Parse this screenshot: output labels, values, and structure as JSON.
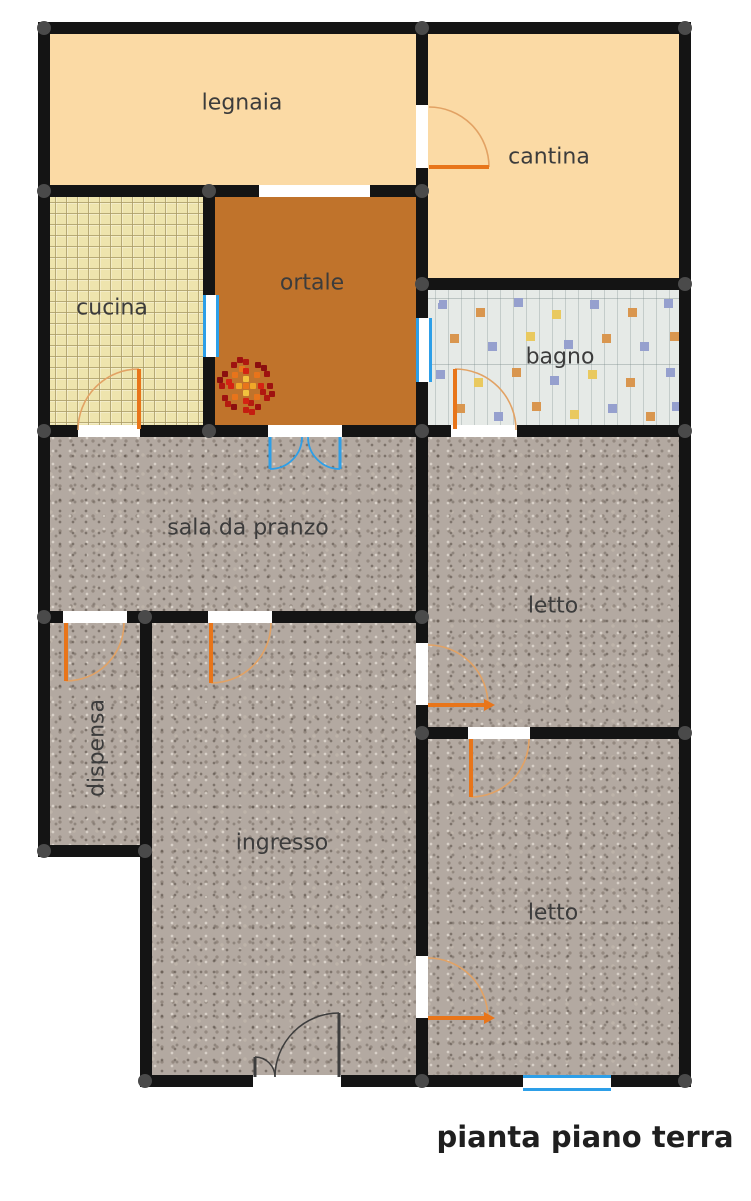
{
  "title": {
    "text": "pianta piano terra"
  },
  "rooms": {
    "legnaia": {
      "label": "legnaia"
    },
    "cantina": {
      "label": "cantina"
    },
    "cucina": {
      "label": "cucina"
    },
    "ortale": {
      "label": "ortale"
    },
    "bagno": {
      "label": "bagno"
    },
    "sala_da_pranzo": {
      "label": "sala da pranzo"
    },
    "letto_1": {
      "label": "letto"
    },
    "dispensa": {
      "label": "dispensa"
    },
    "ingresso": {
      "label": "ingresso"
    },
    "letto_2": {
      "label": "letto"
    }
  },
  "palette": {
    "wall": "#141414",
    "corner_node": "#4a4a4a",
    "door_swing": "#e8751a",
    "door_swing_arc": "#e2a264",
    "entrance_door": "#3d3d3d",
    "window_blue": "#2d9fe8",
    "room_peach": "#fbdaa5",
    "room_ortale_brown": "#c0732b",
    "cucina_tile": "#eee4ad",
    "bagno_tile": "#e6eae7",
    "granite_floor": "#b3a9a1",
    "label_text": "#3c3c3c"
  }
}
